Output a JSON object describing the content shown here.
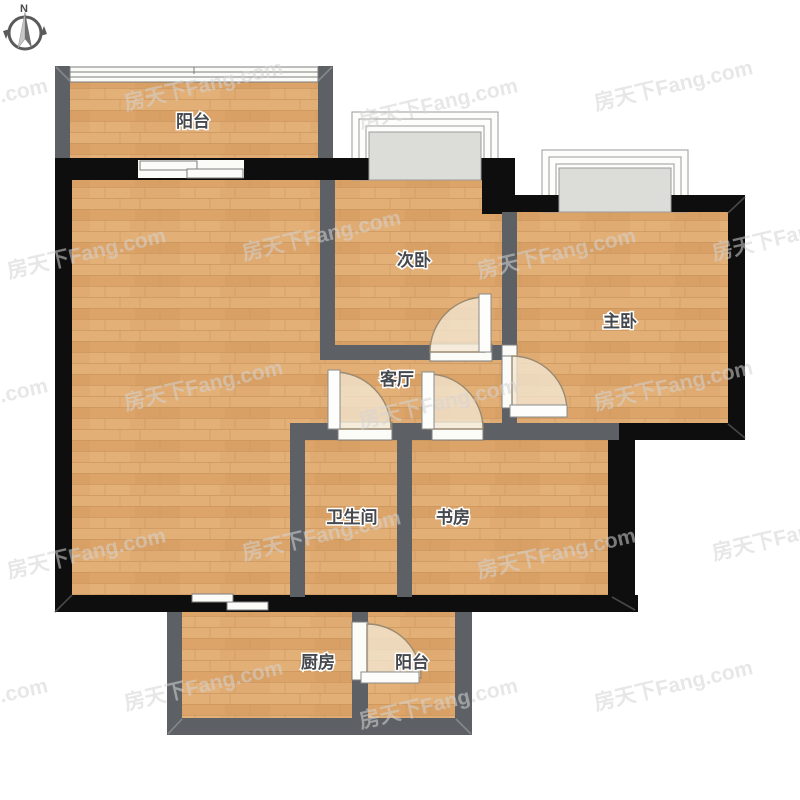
{
  "compass": {
    "label": "N"
  },
  "watermark": {
    "text": "房天下Fang.com"
  },
  "rooms": {
    "balcony_top": {
      "label": "阳台"
    },
    "secondary_bedroom": {
      "label": "次卧"
    },
    "master_bedroom": {
      "label": "主卧"
    },
    "living_room": {
      "label": "客厅"
    },
    "bathroom": {
      "label": "卫生间"
    },
    "study": {
      "label": "书房"
    },
    "kitchen": {
      "label": "厨房"
    },
    "balcony_bottom": {
      "label": "阳台"
    }
  },
  "colors": {
    "wall_black": "#0e0e0e",
    "wall_gray": "#5d6165",
    "floor_base": "#dfaa6f",
    "floor_seam": "#c8935a",
    "window_fill": "#fbfbf8",
    "window_stroke": "#7d7d7d",
    "bay_panel": "#dcdcd9",
    "door_fill": "#f2e7d2",
    "door_stroke": "#9a8a71",
    "label_color": "#45484d",
    "watermark_color": "#d4d4d4",
    "compass_color": "#5a5a5a"
  }
}
